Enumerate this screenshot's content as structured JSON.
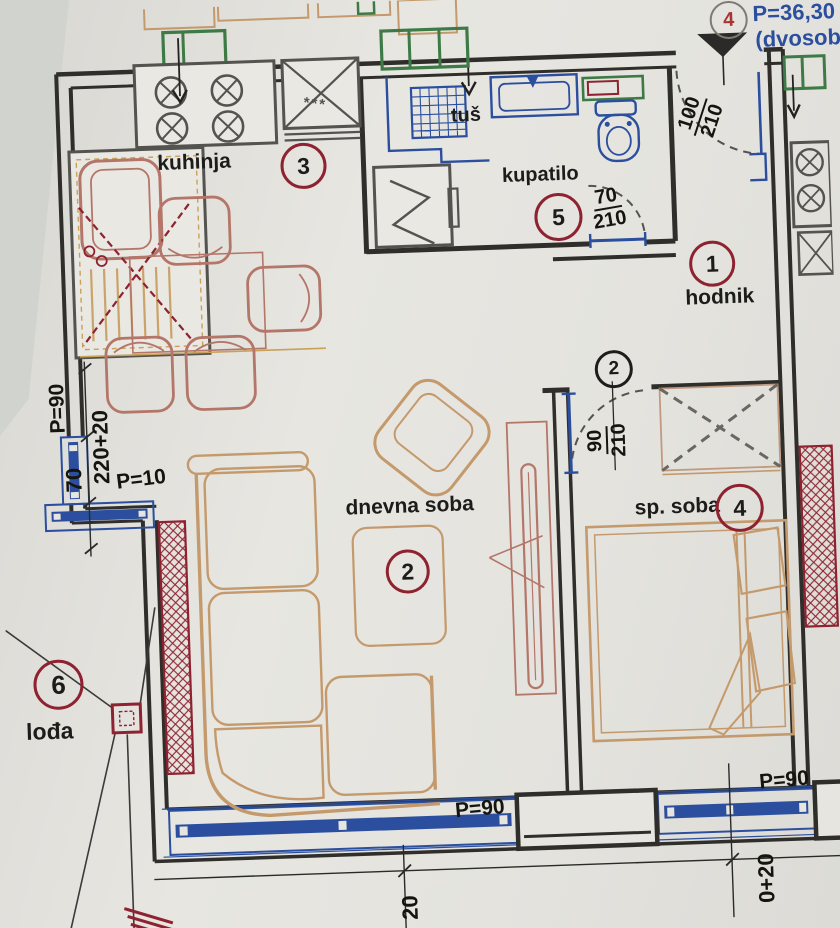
{
  "unit_callout": {
    "number": "4",
    "area": "P=36,30",
    "type": "(dvosob"
  },
  "rooms": [
    {
      "num": "1",
      "name": "hodnik"
    },
    {
      "num": "2",
      "name": "dnevna soba"
    },
    {
      "num": "3",
      "name": "kuhinja"
    },
    {
      "num": "4",
      "name": "sp. soba"
    },
    {
      "num": "5",
      "name": "kupatilo"
    },
    {
      "num": "6",
      "name": "lođa"
    }
  ],
  "markers": {
    "bedroom_door_position": "2"
  },
  "fixtures": {
    "shower": "tuš",
    "freezer_stars": "***"
  },
  "dimensions": {
    "entry_door": {
      "width": "100",
      "height": "210"
    },
    "bath_door": {
      "width": "70",
      "height": "210"
    },
    "bedroom_door": {
      "width": "90",
      "height": "210"
    },
    "left_wall": {
      "parapet": "P=90",
      "window_width": "70",
      "segment": "220+20",
      "low_parapet": "P=10"
    },
    "bottom_wall": {
      "parapet_left": "P=90",
      "parapet_right": "P=90",
      "dim_left": "20",
      "dim_right": "0+20"
    }
  },
  "colors": {
    "wall": "#2f2e2b",
    "plumbing_blue": "#2b4f9e",
    "furniture_tan": "#c49a6c",
    "furniture_red": "#b5766a",
    "accent_red": "#8e2230",
    "vent_green": "#3d7a46",
    "appliance_grey": "#55534f",
    "text": "#1c1c1a",
    "area_text_blue": "#2b4f9e"
  }
}
